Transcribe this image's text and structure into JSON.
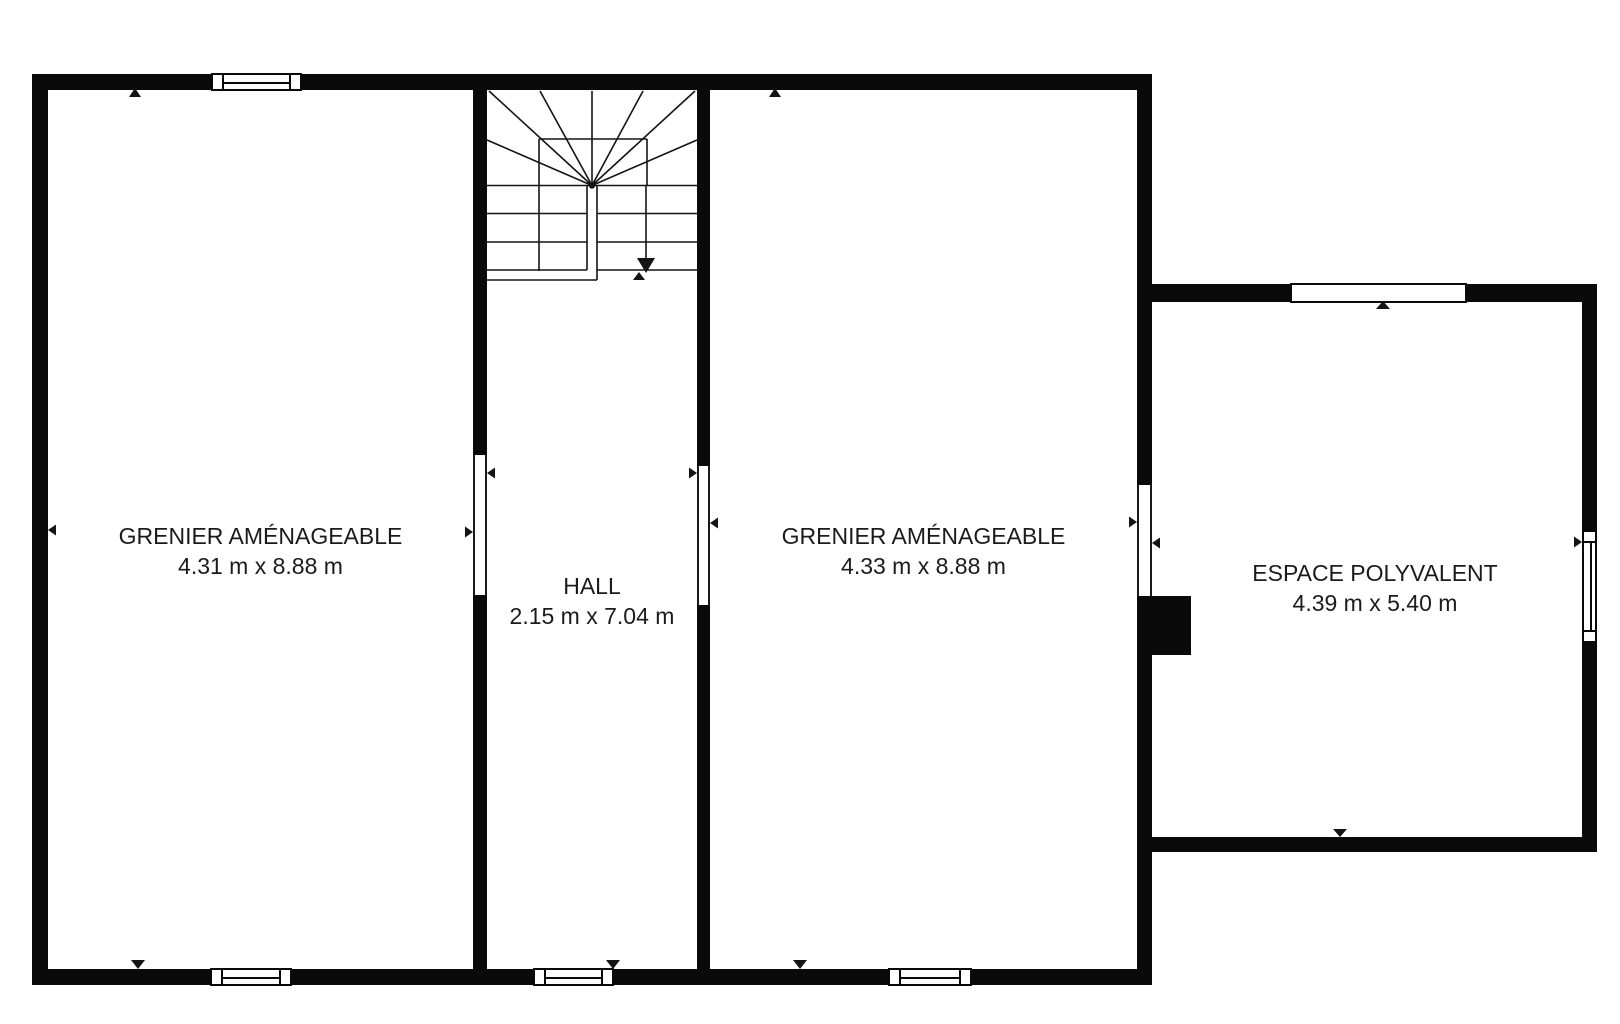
{
  "rooms": {
    "grenier_left": {
      "name": "GRENIER AMÉNAGEABLE",
      "dimensions": "4.31 m x 8.88 m"
    },
    "hall": {
      "name": "HALL",
      "dimensions": "2.15 m x 7.04 m"
    },
    "grenier_right": {
      "name": "GRENIER AMÉNAGEABLE",
      "dimensions": "4.33 m x 8.88 m"
    },
    "espace_polyvalent": {
      "name": "ESPACE POLYVALENT",
      "dimensions": "4.39 m x 5.40 m"
    }
  },
  "colors": {
    "wall": "#0a0a0a",
    "background": "#ffffff",
    "line": "#1a1a1a",
    "text": "#1b1b1b"
  }
}
